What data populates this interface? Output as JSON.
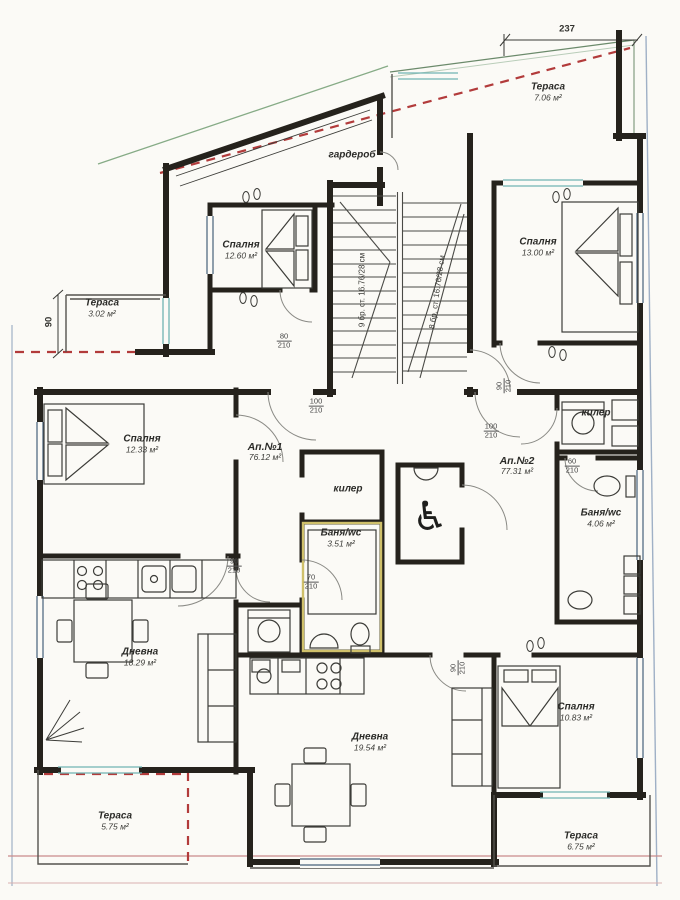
{
  "rooms": {
    "terrace_tr": {
      "name": "Тераса",
      "area": "7.06 м²"
    },
    "wardrobe": {
      "name": "гардероб"
    },
    "bedroom_tl": {
      "name": "Спалня",
      "area": "12.60 м²"
    },
    "bedroom_tr": {
      "name": "Спалня",
      "area": "13.00 м²"
    },
    "terrace_left": {
      "name": "Тераса",
      "area": "3.02 м²"
    },
    "bedroom_ml": {
      "name": "Спалня",
      "area": "12.33 м²"
    },
    "apt1": {
      "name": "Ап.№1",
      "area": "76.12 м²"
    },
    "apt2": {
      "name": "Ап.№2",
      "area": "77.31 м²"
    },
    "closet_center": {
      "name": "килер"
    },
    "bath_center": {
      "name": "Баня/wc",
      "area": "3.51 м²"
    },
    "closet_right": {
      "name": "килер"
    },
    "bath_right": {
      "name": "Баня/wc",
      "area": "4.06 м²"
    },
    "living_left": {
      "name": "Дневна",
      "area": "18.29 м²"
    },
    "living_bottom": {
      "name": "Дневна",
      "area": "19.54 м²"
    },
    "bedroom_br": {
      "name": "Спалня",
      "area": "10.83 м²"
    },
    "terrace_bl": {
      "name": "Тераса",
      "area": "5.75 м²"
    },
    "terrace_br": {
      "name": "Тераса",
      "area": "6.75 м²"
    }
  },
  "stairs": {
    "flight_left": "9 бр. ст. 16.76/28 см",
    "flight_right": "8 бр. ст. 16.76/28 см"
  },
  "dimensions": {
    "top_width": "237",
    "left_height": "90"
  },
  "doors": [
    {
      "id": "wardrobe-area",
      "num": "80",
      "den": "210"
    },
    {
      "id": "apt1-entry",
      "num": "100",
      "den": "210"
    },
    {
      "id": "stair-right",
      "num": "90",
      "den": "210"
    },
    {
      "id": "apt2-entry",
      "num": "100",
      "den": "210"
    },
    {
      "id": "bedroom-ml",
      "num": "90",
      "den": "210"
    },
    {
      "id": "bath-center",
      "num": "70",
      "den": "210"
    },
    {
      "id": "bath-right",
      "num": "60",
      "den": "210"
    },
    {
      "id": "living-bottom",
      "num": "90",
      "den": "210"
    }
  ],
  "icons": {
    "wheelchair": "♿"
  },
  "colors": {
    "wall": "#25221c",
    "red_dashed": "#b23b3b",
    "boundary_blue": "#9fb0c6",
    "boundary_pink": "#c98b8b",
    "green_line": "#86ab86",
    "window_teal": "#6fb3b3",
    "bath_highlight": "#cfc06a"
  }
}
